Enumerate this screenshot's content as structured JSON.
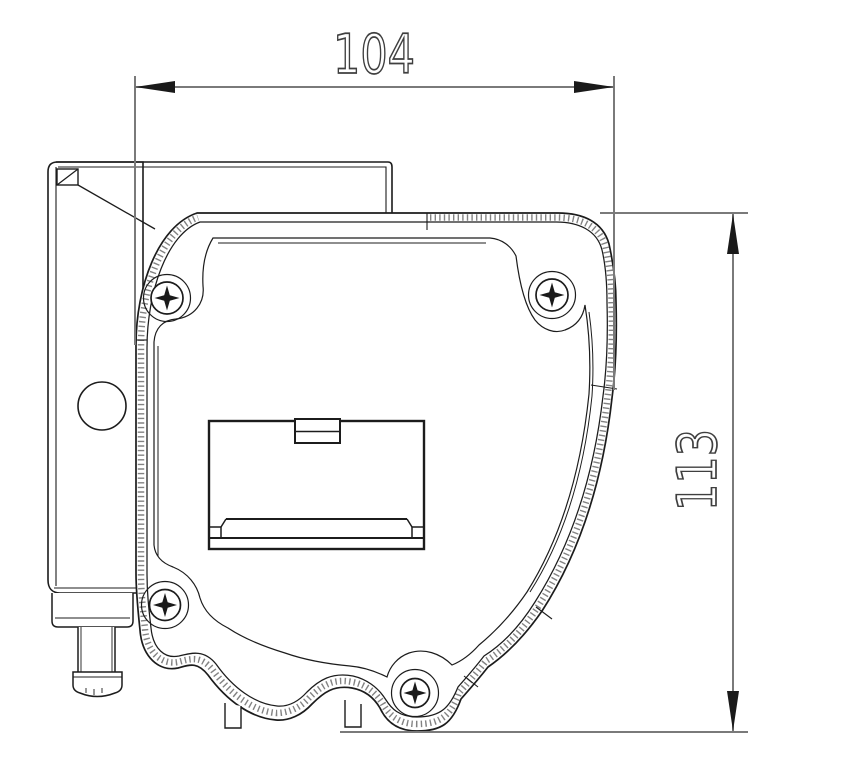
{
  "drawing": {
    "dimensions": {
      "width": {
        "value": "104"
      },
      "height": {
        "value": "113"
      }
    },
    "colors": {
      "background": "#ffffff",
      "outline": "#1c1c1c",
      "dimension_line": "#7a7a7a",
      "dimension_text": "#3f3f3f",
      "arrowhead": "#1a1a1a"
    }
  }
}
